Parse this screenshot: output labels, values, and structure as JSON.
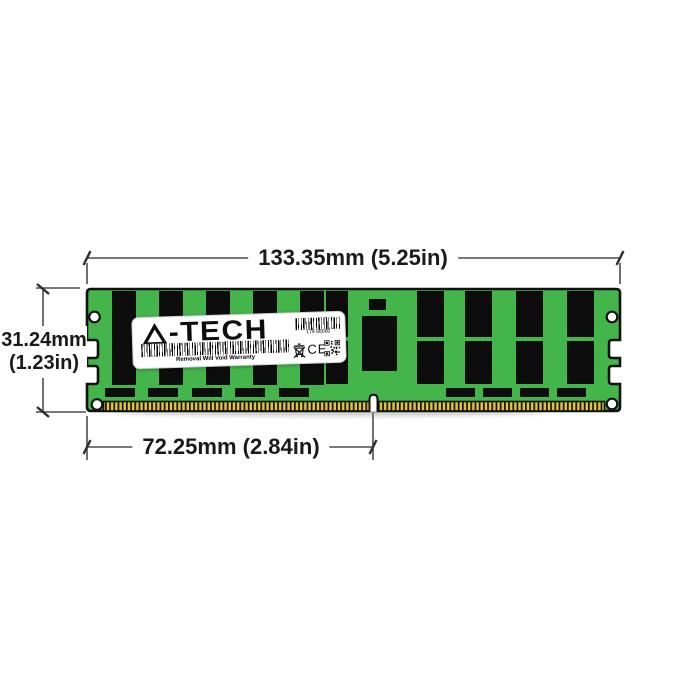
{
  "diagram": {
    "subject": "memory-module-dimension-diagram"
  },
  "dimensions": {
    "width": "133.35mm (5.25in)",
    "height_line1": "31.24mm",
    "height_line2": "(1.23in)",
    "pin_span": "72.25mm (2.84in)"
  },
  "label": {
    "brand": "A-TECH",
    "brand_suffix": "-TECH",
    "serial": "179 88000",
    "warranty": "Removal Will Void Warranty",
    "ce_mark": "CE"
  },
  "icons": {
    "logo_a": "a-tech-triangle-logo",
    "serial_barcode": "barcode",
    "warranty_barcode": "barcode",
    "weee": "weee-crossed-out-bin",
    "qr": "qr-code"
  },
  "colors": {
    "pcb": "#43b54a",
    "pins_gold": "#e3c436",
    "chips": "#0d0d0d",
    "outline": "#111111",
    "dimension_lines": "#4c4c4c",
    "text": "#1a1a1a",
    "label_bg": "#ffffff"
  }
}
